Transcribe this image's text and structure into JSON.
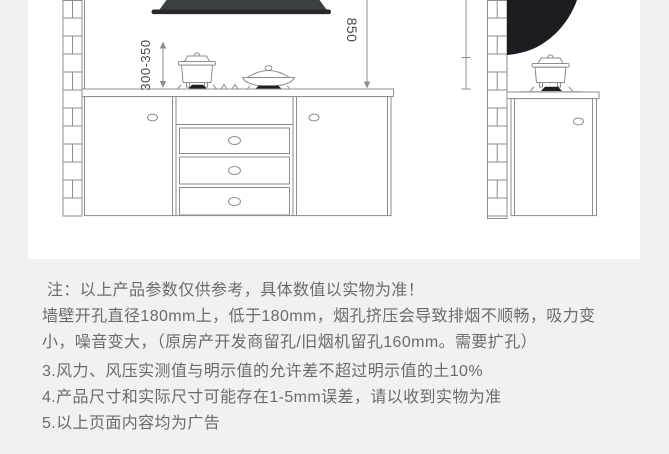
{
  "theme": {
    "page-bg": "#f1f1f2",
    "panel-bg": "#ffffff",
    "line": "#8c8d90",
    "hood-dark": "#3c3f44",
    "hood-lip": "#26282b",
    "hood-side": "#1b1d20",
    "burner": "#1f1f1f",
    "dim-text": "#4a4a4a",
    "note-text": "#6b6b6b"
  },
  "diagram": {
    "front_view": {
      "clearance_label": "300-350",
      "hood_height_label": "850"
    }
  },
  "notes": {
    "lines": [
      "注：以上产品参数仅供参考，具体数值以实物为准！",
      "墙壁开孔直径180mm上，低于180mm，烟孔挤压会导致排烟不顺畅，吸力变",
      "小，噪音变大，（原房产开发商留孔/旧烟机留孔160mm。需要扩孔）",
      "3.风力、风压实测值与明示值的允许差不超过明示值的土10%",
      "4.产品尺寸和实际尺寸可能存在1-5mm误差，请以收到实物为准",
      "5.以上页面内容均为广告"
    ]
  }
}
